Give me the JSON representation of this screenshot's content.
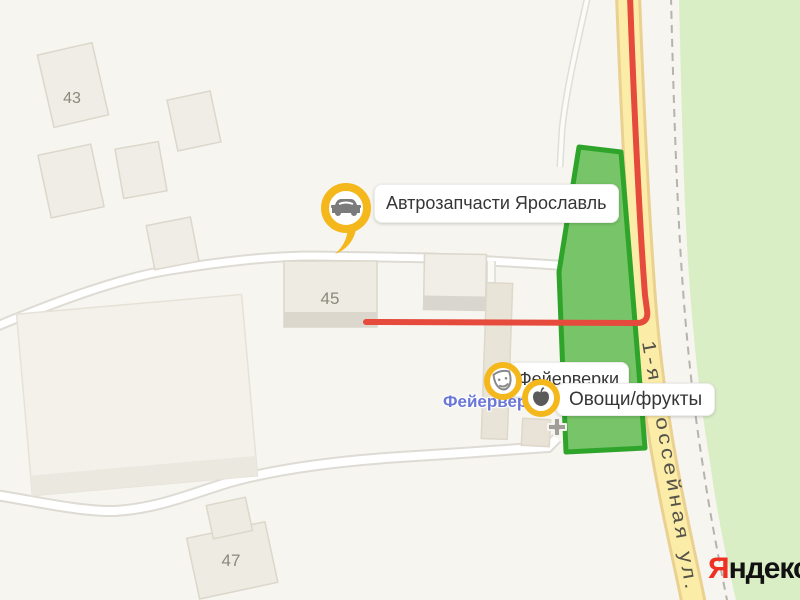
{
  "map_type": "yandex-map-fragment",
  "buildings": {
    "b43": "43",
    "b45": "45",
    "b47": "47"
  },
  "roads": {
    "main_street": "1-я Шоссейная ул."
  },
  "markers": {
    "autoparts": {
      "label": "Автрозапчасти Ярославль",
      "icon": "car-icon"
    },
    "fireworks": {
      "label": "Фейерверки",
      "icon": "theater-masks-icon"
    },
    "produce": {
      "label": "Овощи/фрукты",
      "icon": "apple-icon"
    }
  },
  "poi": {
    "fireworks_store": "Фейерверки"
  },
  "logo": {
    "first_letter": "Я",
    "rest": "ндекс"
  },
  "colors": {
    "marker_yellow": "#f4b71c",
    "route_red": "#e64a3c",
    "selected_area_fill": "#77c568",
    "selected_area_stroke": "#2fa42b",
    "vegetation_green": "#daeec6",
    "main_road_yellow": "#fbeda7",
    "poi_label_blue": "#6b77d6",
    "logo_red": "#ef3124",
    "background": "#f7f5ef"
  }
}
